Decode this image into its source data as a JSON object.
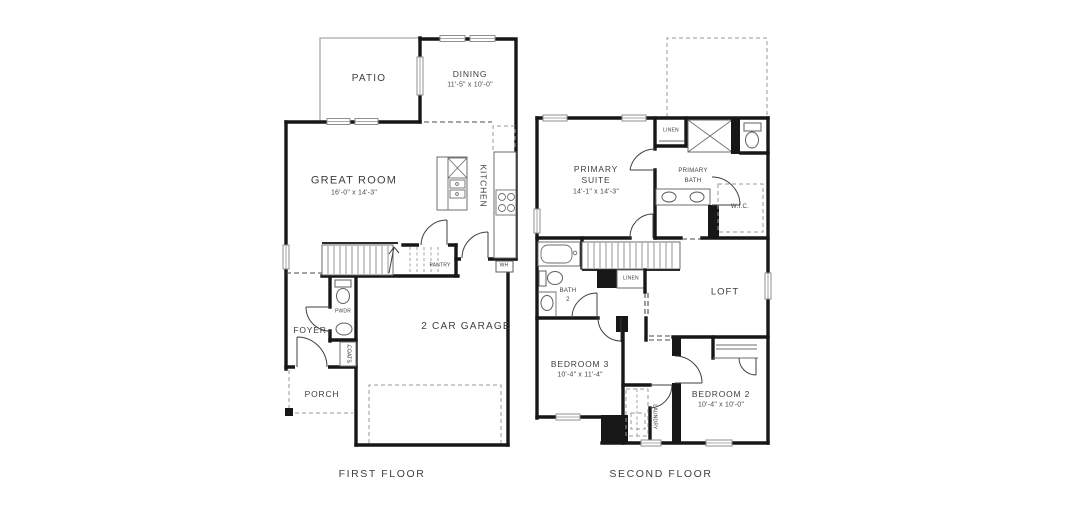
{
  "colors": {
    "wall": "#171717",
    "text": "#3e3e3e",
    "background": "#ffffff"
  },
  "first_floor": {
    "title": "FIRST FLOOR",
    "rooms": {
      "patio": {
        "label": "PATIO"
      },
      "dining": {
        "label": "DINING",
        "dims": "11'-5\" x 10'-0\""
      },
      "great_room": {
        "label": "GREAT ROOM",
        "dims": "16'-0\" x 14'-3\""
      },
      "kitchen": {
        "label": "KITCHEN"
      },
      "pantry": {
        "label": "PANTRY"
      },
      "water_heater": {
        "label": "WH"
      },
      "powder": {
        "label": "PWDR"
      },
      "coats": {
        "label": "COATS"
      },
      "foyer": {
        "label": "FOYER"
      },
      "garage": {
        "label": "2 CAR GARAGE"
      },
      "porch": {
        "label": "PORCH"
      }
    }
  },
  "second_floor": {
    "title": "SECOND FLOOR",
    "rooms": {
      "primary_suite": {
        "label_line1": "PRIMARY",
        "label_line2": "SUITE",
        "dims": "14'-1\" x 14'-3\""
      },
      "linen_upper": {
        "label": "LINEN"
      },
      "primary_bath": {
        "label_line1": "PRIMARY",
        "label_line2": "BATH"
      },
      "wic": {
        "label": "W.I.C."
      },
      "bath2": {
        "label_line1": "BATH",
        "label_line2": "2"
      },
      "linen_hall": {
        "label": "LINEN"
      },
      "loft": {
        "label": "LOFT"
      },
      "bedroom3": {
        "label": "BEDROOM 3",
        "dims": "10'-4\" x 11'-4\""
      },
      "laundry": {
        "label": "LAUNDRY"
      },
      "bedroom2": {
        "label": "BEDROOM 2",
        "dims": "10'-4\" x 10'-0\""
      }
    }
  }
}
